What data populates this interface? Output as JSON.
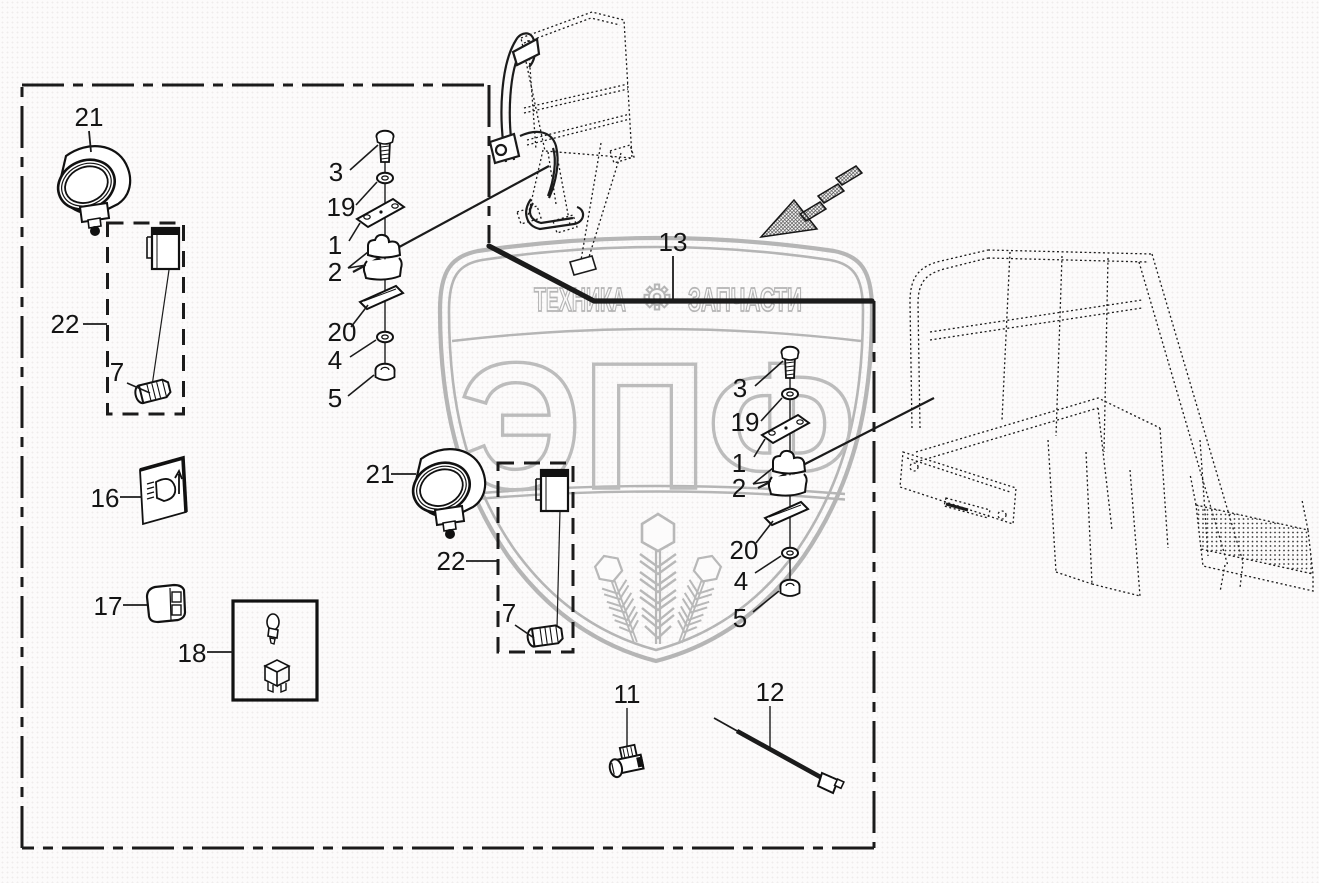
{
  "page": {
    "type": "exploded-parts-diagram",
    "background": "#fcfbfb",
    "line_color": "#1b1b1b"
  },
  "watermark": {
    "top_left_word": "ТЕХНИКА",
    "top_right_word": "ЗАПЧАСТИ",
    "monogram": "ЭПФ",
    "color": "#b5b5b5",
    "icons": [
      "gear-icon",
      "shield-outline",
      "wheat-emblem"
    ]
  },
  "callouts": {
    "n1": "1",
    "n2": "2",
    "n3": "3",
    "n4": "4",
    "n5": "5",
    "n7": "7",
    "n11": "11",
    "n12": "12",
    "n13": "13",
    "n16": "16",
    "n17": "17",
    "n18": "18",
    "n19": "19",
    "n20": "20",
    "n21": "21",
    "n22": "22"
  }
}
